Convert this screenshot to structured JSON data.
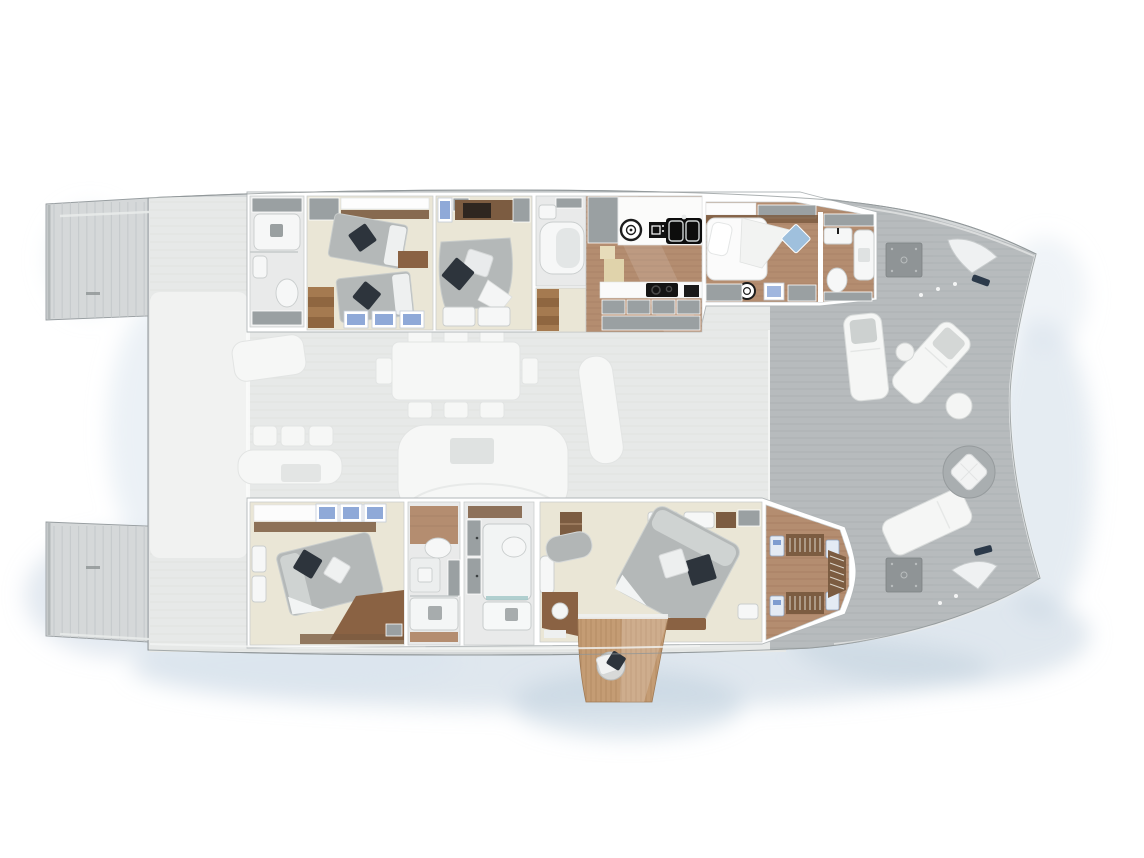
{
  "palette": {
    "shadow": "#bfcfde",
    "shadowLight": "#dbe5ee",
    "hull": "#d5d8d9",
    "hullEdge": "#979da0",
    "deck": "#b7bbbd",
    "plank": "#a6abad",
    "faded": "#e7e9e8",
    "fadedFurn": "#f6f7f6",
    "cockpit": "#f1f2f1",
    "wall": "#ffffff",
    "roomStroke": "#c6cacb",
    "cabinFloor": "#eae6d6",
    "tile": "#e9eaea",
    "wood": "#b48d70",
    "woodDark": "#7c5c41",
    "woodMid": "#8a6243",
    "cabinet": "#9aa0a2",
    "bedGray": "#b4b8b8",
    "bedLight": "#d9dcdb",
    "pillowDark": "#2d343c",
    "pillowWhite": "#eceeef",
    "winBlue": "#8fa9d8",
    "black": "#141414",
    "white": "#f6f7f7",
    "balconyWood": "#c49c74",
    "poufGray": "#a9aeb0",
    "navy": "#2c3a4a"
  },
  "diagram": {
    "type": "yacht-floor-plan",
    "vessel": "catamaran, top view, bow to the right",
    "decks": {
      "aft": [
        "starboard swim platform with steps",
        "port swim platform with steps",
        "aft cockpit seating (faded)"
      ],
      "main_faded": [
        "salon dining table with eight chairs",
        "curved salon sofa with low table",
        "helm seat",
        "cockpit bench with three chairs and table",
        "aft sunpad"
      ],
      "foredeck": [
        "sun lounger with cushion",
        "angled sun lounger with cushion",
        "forward sun lounger",
        "round side table",
        "round cocktail table",
        "round pouf with pillow",
        "deck hatch",
        "deck hatch",
        "anchor locker",
        "anchor locker",
        "mooring cleat"
      ],
      "starboard_hull": [
        "aft bathroom with shower and toilet",
        "twin guest cabin with two single beds",
        "VIP double cabin with TV cabinet",
        "VIP en-suite shower room",
        "galley with double sink, washer, oven and cooktop",
        "forward crew cabin",
        "forward bathroom"
      ],
      "port_hull": [
        "guest double cabin with desk",
        "guest bathroom with vanity and shower",
        "shower room with large shower and toilet",
        "owner master cabin with king bed, chaise and vanity desk",
        "walk-in wardrobe with hanging rails"
      ],
      "stern_extras": [
        "fold-down teak balcony with round seat"
      ]
    }
  }
}
